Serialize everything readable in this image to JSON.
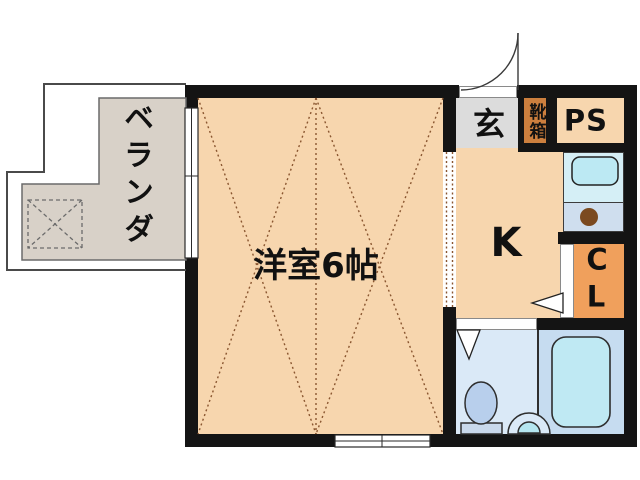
{
  "floorplan": {
    "balcony": {
      "label": "ベランダ"
    },
    "main_room": {
      "label": "洋室6帖"
    },
    "entrance": {
      "label": "玄"
    },
    "shoe_box": {
      "label": "靴箱"
    },
    "pipe_space": {
      "label": "PS"
    },
    "kitchen": {
      "label": "K"
    },
    "closet": {
      "char_top": "C",
      "char_bottom": "L"
    },
    "colors": {
      "wall": "#141414",
      "room_fill": "#f7d6ae",
      "balcony_fill": "#d8d1c8",
      "entrance_fill": "#dcdcdc",
      "shoe_box_fill": "#cc7f3e",
      "closet_fill": "#f0a05c",
      "sink_counter_fill": "#d5eff6",
      "stove_counter_fill": "#cfdeee",
      "bathroom_fill": "#dae9f7",
      "bath_fill": "#c6dcf0",
      "bathtub_fill": "#bfe9f3",
      "sink_fill": "#bce9f3",
      "burner_fill": "#7b4a20",
      "toilet_fill": "#b8cfec",
      "dotted_line": "#8a5630"
    }
  }
}
